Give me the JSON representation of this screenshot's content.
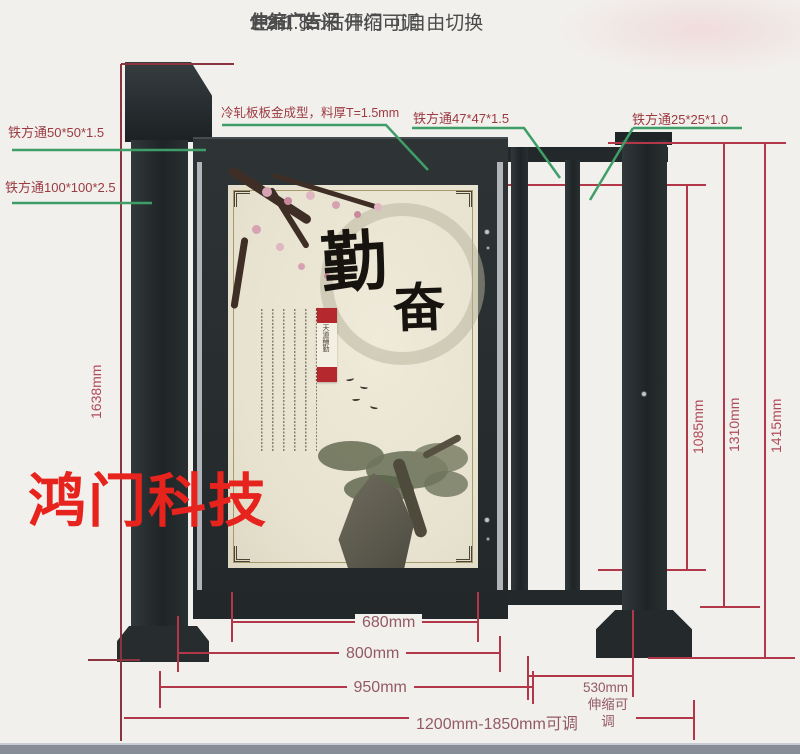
{
  "header": {
    "line1": "伸缩广告门",
    "line2": "1.2-1.85米 伸缩可调",
    "line3": "左开门、右开门 可自由切换"
  },
  "callouts": {
    "tube_50": "铁方通50*50*1.5",
    "tube_100": "铁方通100*100*2.5",
    "cold_rolled_plate": "冷轧板板金成型，料厚T=1.5mm",
    "tube_47": "铁方通47*47*1.5",
    "tube_25": "铁方通25*25*1.0"
  },
  "dimensions": {
    "left_total_height": "1638mm",
    "fence_inner_height": "1085mm",
    "fence_frame_height": "1310mm",
    "post_height": "1415mm",
    "panel_width": "680mm",
    "door_width": "800mm",
    "door_span": "950mm",
    "extension_width": "530mm",
    "extension_note": "伸缩可调",
    "total_span": "1200mm-1850mm可调"
  },
  "watermark": "鸿门科技",
  "ad_panel": {
    "calligraphy_char_1": "勤",
    "calligraphy_char_2": "奋",
    "seal_text": "天道酬勤"
  },
  "colors": {
    "dimension_red": "#b23748",
    "dimension_maroon": "#8c3340",
    "leader_green": "#3f9e68",
    "gate_dark": "#24292c",
    "panel_beige": "#e9e4d2",
    "watermark_red": "#e6231c",
    "seal_red": "#b5282e"
  }
}
